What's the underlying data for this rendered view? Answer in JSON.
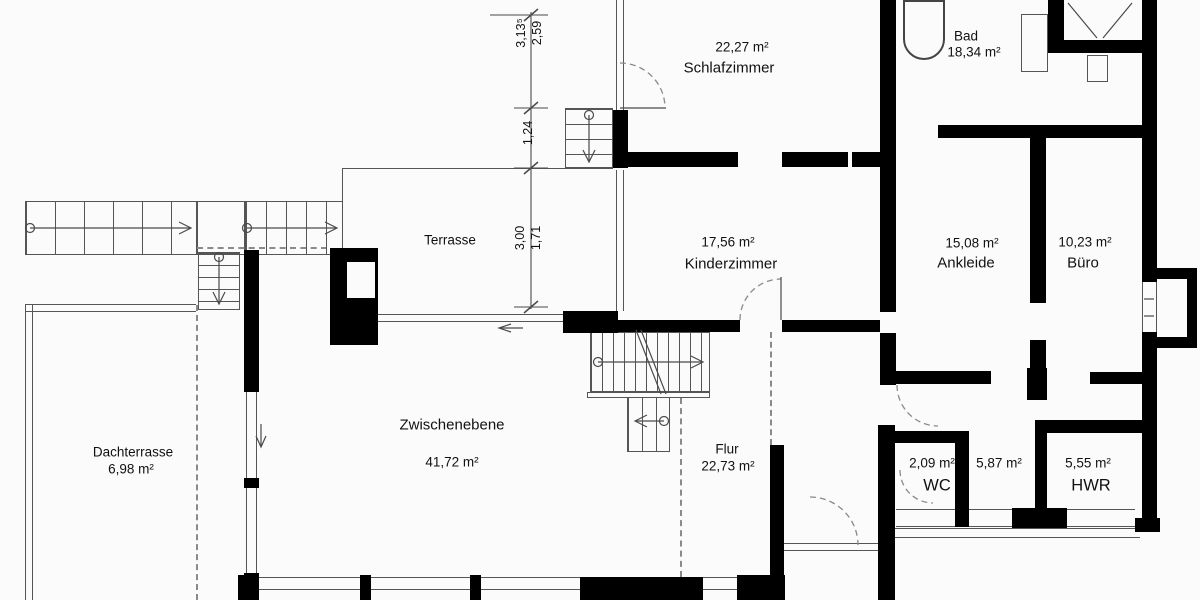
{
  "colors": {
    "wall": "#000000",
    "line": "#555555",
    "dashed": "#8a8a8a",
    "text": "#111111",
    "background": "#fbfbfb"
  },
  "rooms": [
    {
      "name": "Schlafzimmer",
      "area": "22,27 m²"
    },
    {
      "name": "Bad",
      "area": "18,34 m²"
    },
    {
      "name": "Terrasse",
      "area": ""
    },
    {
      "name": "Kinderzimmer",
      "area": "17,56 m²"
    },
    {
      "name": "Ankleide",
      "area": "15,08 m²"
    },
    {
      "name": "Büro",
      "area": "10,23 m²"
    },
    {
      "name": "Zwischenebene",
      "area": "41,72 m²"
    },
    {
      "name": "Flur",
      "area": "22,73 m²"
    },
    {
      "name": "Dachterrasse",
      "area": "6,98 m²"
    },
    {
      "name": "WC",
      "area": "2,09 m²"
    },
    {
      "name": "",
      "area": "5,87 m²"
    },
    {
      "name": "HWR",
      "area": "5,55 m²"
    }
  ],
  "dimensions": [
    "3,13⁵",
    "2,59",
    "1,24",
    "3,00",
    "1,71"
  ]
}
